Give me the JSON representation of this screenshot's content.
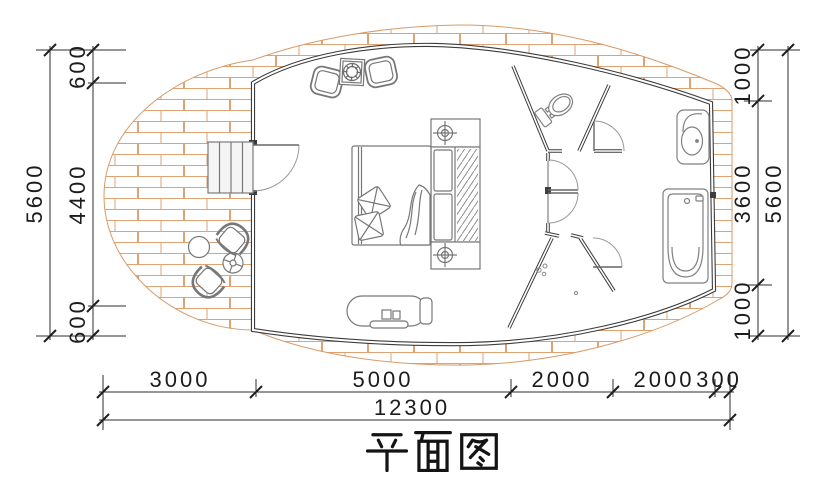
{
  "title": "平面图",
  "colors": {
    "deck_hatch": "#dfa273",
    "wall_line": "#3c3c3c",
    "dim_line": "#2c2c2c"
  },
  "dimensions": {
    "left": {
      "overall": "5600",
      "segments": [
        "600",
        "4400",
        "600"
      ]
    },
    "right": {
      "overall": "5600",
      "segments": [
        "1000",
        "3600",
        "1000"
      ]
    },
    "bottom": {
      "overall": "12300",
      "segments": [
        "3000",
        "5000",
        "2000",
        "2000",
        "300"
      ]
    }
  }
}
